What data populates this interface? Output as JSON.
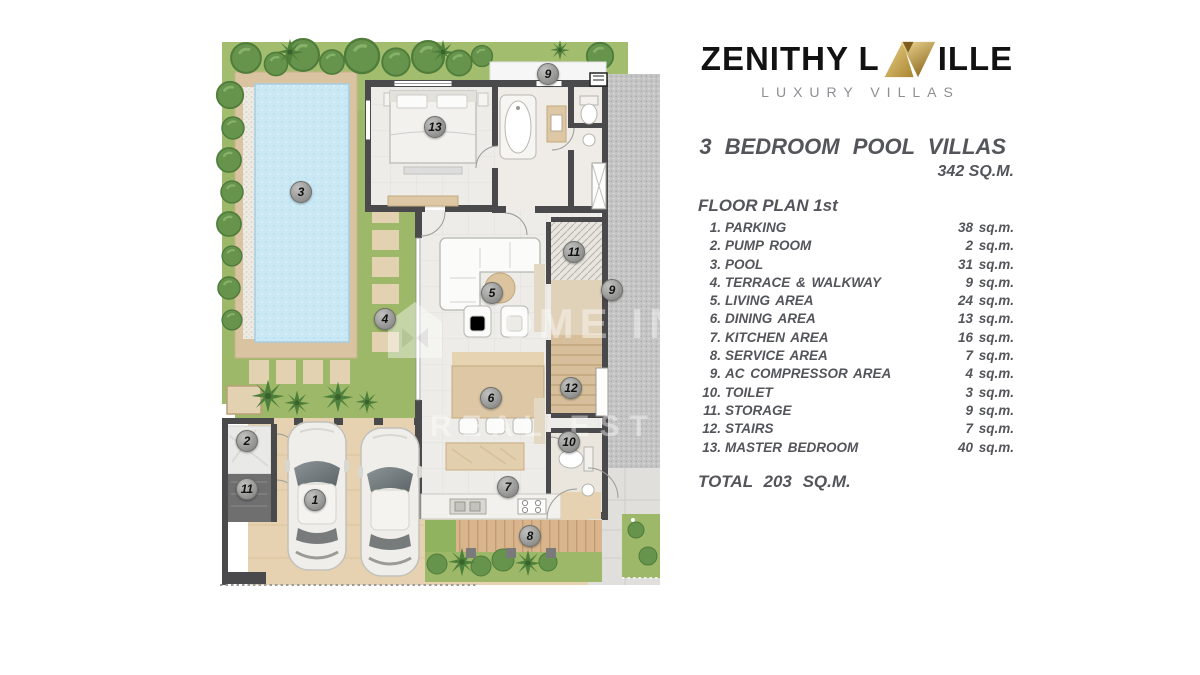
{
  "logo": {
    "text_left": "ZENITHY L",
    "text_right": "ILLE",
    "subtitle": "LUXURY VILLAS"
  },
  "header": {
    "title": "3 BEDROOM POOL VILLAS",
    "total_area": "342 SQ.M.",
    "plan_label": "FLOOR PLAN 1st"
  },
  "legend": {
    "items": [
      {
        "num": "1.",
        "label": "PARKING",
        "area": "38 sq.m."
      },
      {
        "num": "2.",
        "label": "PUMP ROOM",
        "area": "2 sq.m."
      },
      {
        "num": "3.",
        "label": "POOL",
        "area": "31 sq.m."
      },
      {
        "num": "4.",
        "label": "TERRACE & WALKWAY",
        "area": "9 sq.m."
      },
      {
        "num": "5.",
        "label": "LIVING AREA",
        "area": "24 sq.m."
      },
      {
        "num": "6.",
        "label": "DINING AREA",
        "area": "13 sq.m."
      },
      {
        "num": "7.",
        "label": "KITCHEN AREA",
        "area": "16 sq.m."
      },
      {
        "num": "8.",
        "label": "SERVICE AREA",
        "area": "7 sq.m."
      },
      {
        "num": "9.",
        "label": "AC COMPRESSOR AREA",
        "area": "4 sq.m."
      },
      {
        "num": "10.",
        "label": "TOILET",
        "area": "3 sq.m."
      },
      {
        "num": "11.",
        "label": "STORAGE",
        "area": "9 sq.m."
      },
      {
        "num": "12.",
        "label": "STAIRS",
        "area": "7 sq.m."
      },
      {
        "num": "13.",
        "label": "MASTER BEDROOM",
        "area": "40 sq.m."
      }
    ],
    "total": "TOTAL 203 SQ.M."
  },
  "plan": {
    "badges": [
      {
        "n": "1"
      },
      {
        "n": "2"
      },
      {
        "n": "3"
      },
      {
        "n": "4"
      },
      {
        "n": "5"
      },
      {
        "n": "6"
      },
      {
        "n": "7"
      },
      {
        "n": "8"
      },
      {
        "n": "9"
      },
      {
        "n": "9"
      },
      {
        "n": "10"
      },
      {
        "n": "11"
      },
      {
        "n": "11"
      },
      {
        "n": "12"
      },
      {
        "n": "13"
      }
    ]
  },
  "watermark": {
    "line1": "OME IN",
    "line2": "REAL EST"
  },
  "colors": {
    "gold": "#c9a24b",
    "text": "#54555a",
    "wall": "#4a4a4c",
    "grass": "#a3bd6f",
    "pool": "#c9e8f4",
    "deck_tan": "#d9c3a1",
    "wood_deck": "#d9b58d",
    "gravel": "#c4c4c4"
  }
}
